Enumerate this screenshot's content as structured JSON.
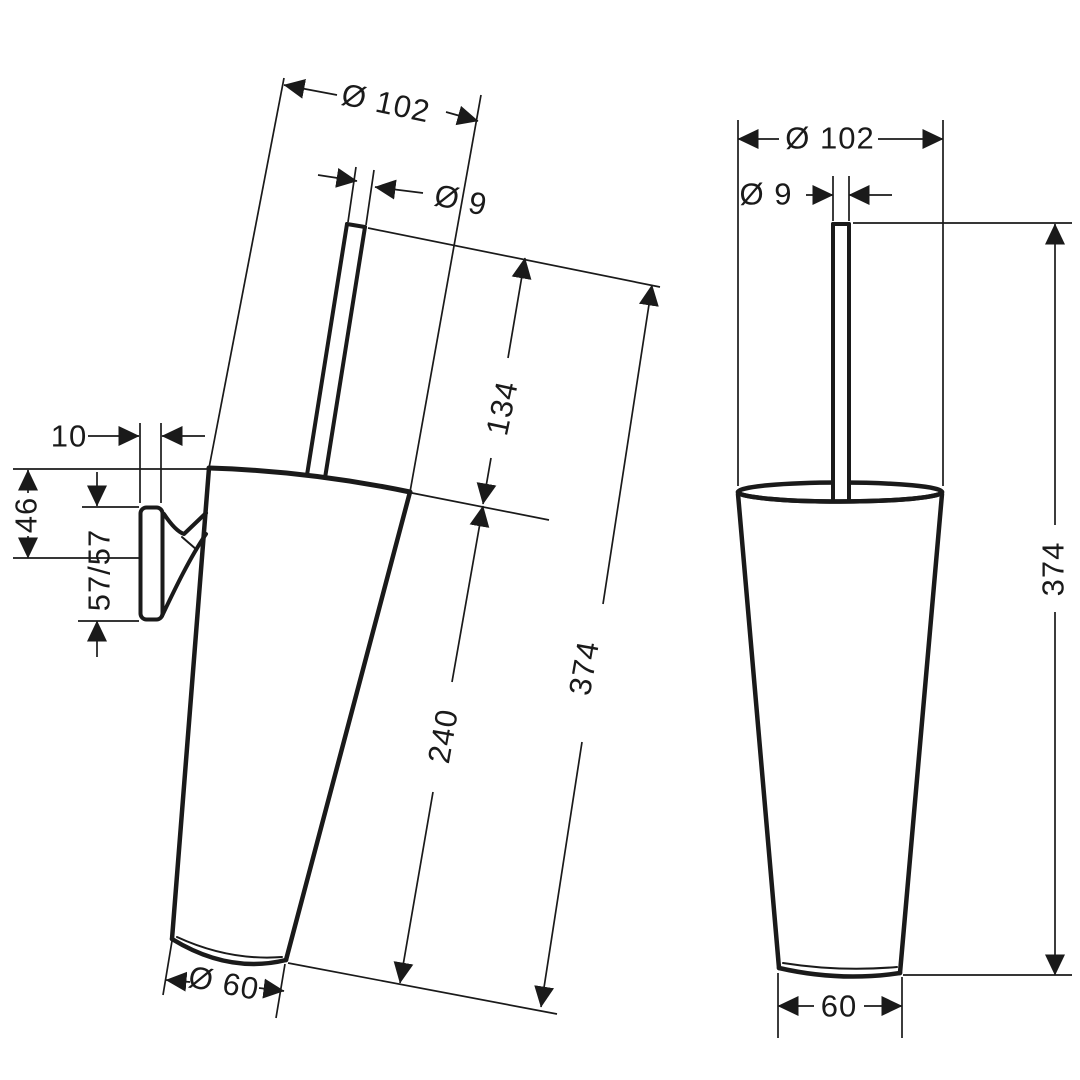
{
  "page": {
    "background": "#ffffff",
    "line_color": "#1a1a1a",
    "description": "Technical dimension drawing of a wall-mounted conical toilet brush holder, two views"
  },
  "views": {
    "left": {
      "label": "side view, wall-mounted (tilted)",
      "dims": {
        "dia_top": "Ø 102",
        "dia_handle": "Ø 9",
        "handle_above_rim": "134",
        "container_height": "240",
        "total_height": "374",
        "dia_bottom": "Ø 60",
        "bracket_thickness": "10",
        "rim_to_bracket_center": "46",
        "bracket_plate_height": "57/57"
      }
    },
    "right": {
      "label": "front view, upright",
      "dims": {
        "dia_top": "Ø 102",
        "dia_handle": "Ø 9",
        "total_height": "374",
        "bottom_width": "60"
      }
    }
  }
}
